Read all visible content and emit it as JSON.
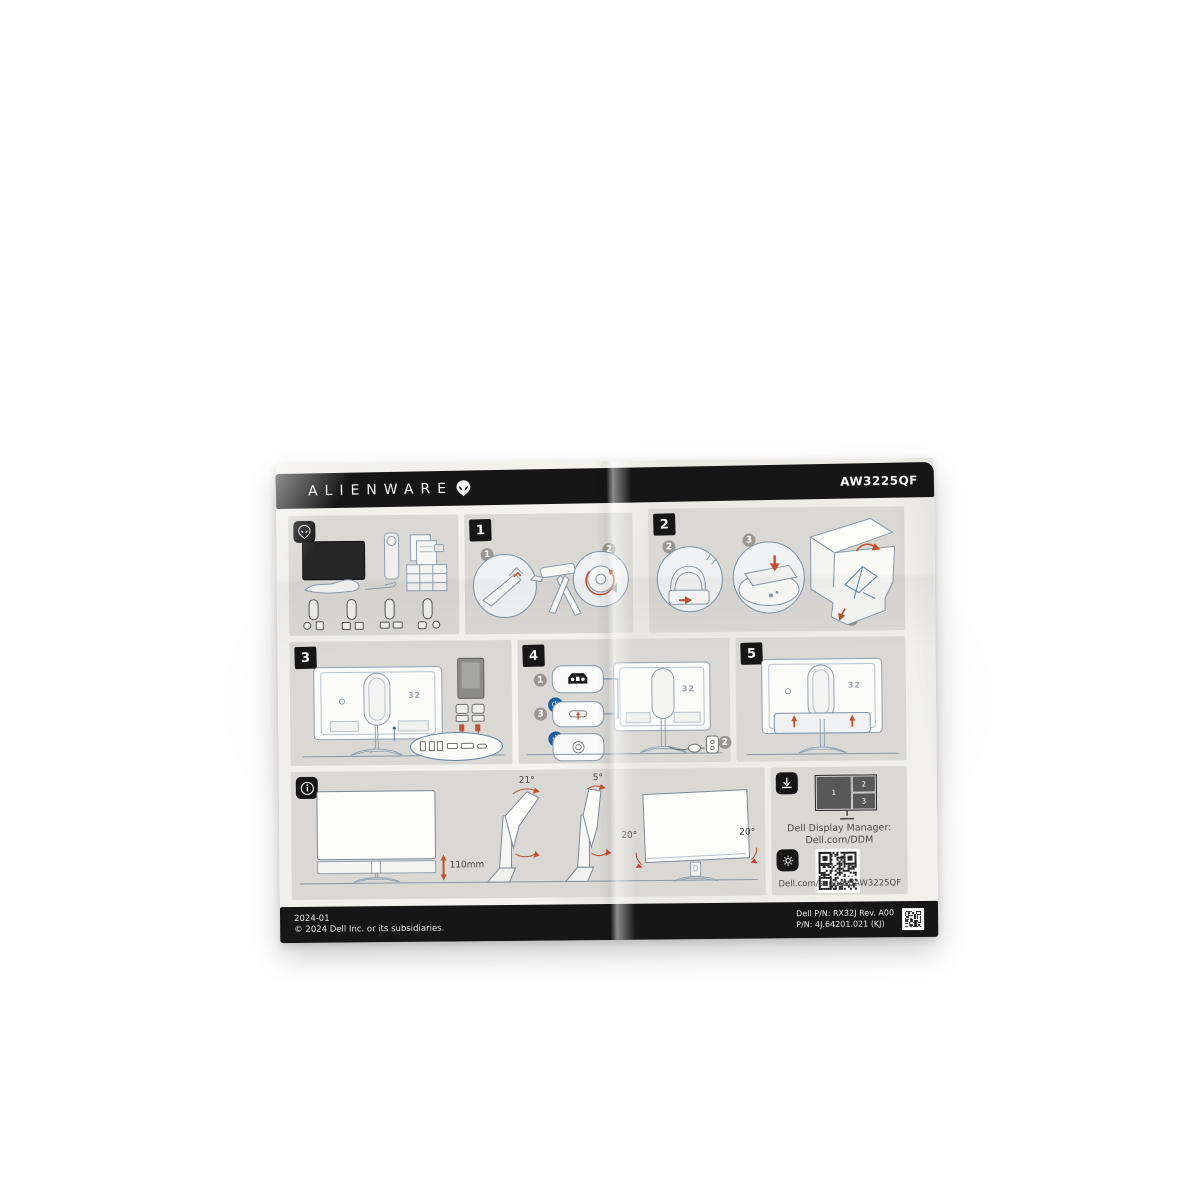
{
  "photo": {
    "description": "Alienware AW3225QF monitor quick setup guide leaflet on white background"
  },
  "header": {
    "brand": "ALIENWARE",
    "model": "AW3225QF"
  },
  "panels": {
    "step1": {
      "badge": "1",
      "callouts": [
        "1",
        "2"
      ]
    },
    "step2": {
      "badge": "2",
      "callouts": [
        "2",
        "3"
      ],
      "box_callout_top": "4",
      "box_callout_bottom": "1"
    },
    "step3": {
      "badge": "3",
      "monitor_logo": "32"
    },
    "step4": {
      "badge": "4",
      "callout_power": "1",
      "callout_usbc": "3",
      "callout_outlet": "2",
      "monitor_logo": "32"
    },
    "step5": {
      "badge": "5",
      "monitor_logo": "32"
    },
    "info": {
      "height": "110mm",
      "tilt_back": "21°",
      "tilt_forward": "5°",
      "swivel_left": "20°",
      "swivel_right": "20°"
    },
    "software": {
      "pbp": [
        "1",
        "2",
        "3"
      ],
      "ddm_label": "Dell Display Manager:",
      "ddm_link": "Dell.com/DDM",
      "support_link": "Dell.com/support/AW3225QF"
    }
  },
  "footer": {
    "date": "2024-01",
    "copyright": "© 2024 Dell Inc. or its subsidiaries.",
    "pn_line1": "Dell P/N: RX32J Rev. A00",
    "pn_line2": "P/N: 4J.64201.021  (KJ)"
  },
  "colors": {
    "accent": "#c2512e",
    "link": "#2e7fc2",
    "panel": "#d9d8d5",
    "bar": "#161616",
    "badge_blue": "#1d5c9d",
    "stroke": "#93a0ad"
  }
}
